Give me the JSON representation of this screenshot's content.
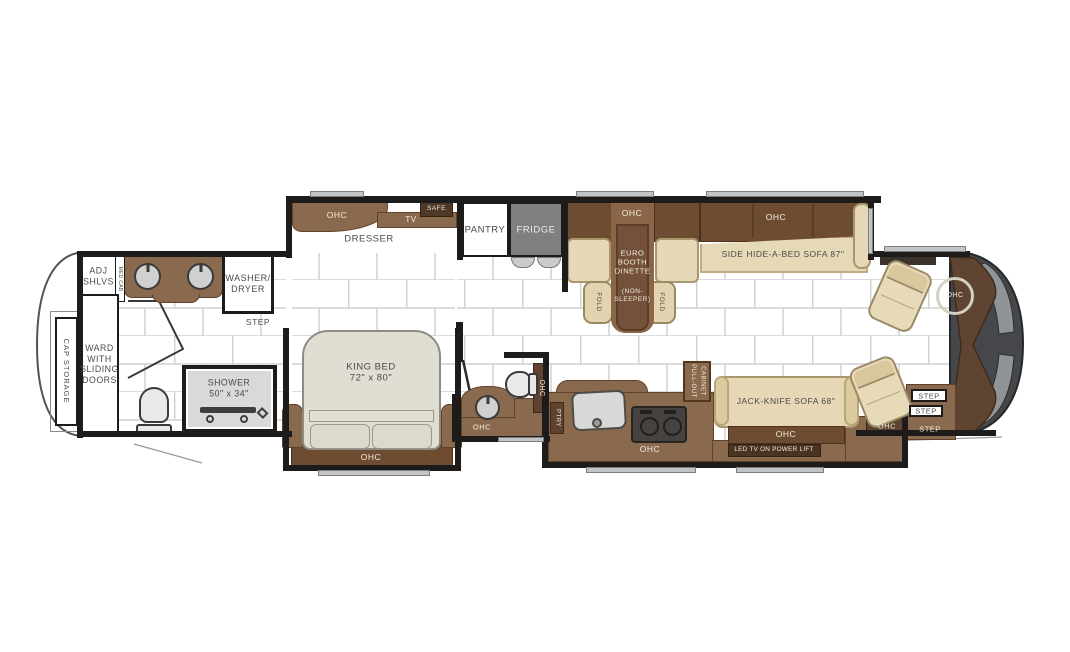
{
  "title": "Class A motorhome floor plan",
  "colors": {
    "wall": "#1d1c1a",
    "cabinet": "#8a6a4e",
    "cabinet_dark": "#6d4c32",
    "cabinet_deep": "#5f4330",
    "tan": "#e6d8b6",
    "bed": "#e0ddd3",
    "fridge_gray": "#7d7f81",
    "front_cap": "#45474a",
    "windshield": "#8f9497",
    "tile_line": "#cfcfcf",
    "label": "#4a4a4a",
    "label_light": "#f2ecdf"
  },
  "rooms": {
    "rear": {
      "cap_storage": "CAP STORAGE",
      "adj_shlvs": "ADJ\nSHLVS",
      "med_cab": "MED CAB",
      "washer_dryer": "WASHER/\nDRYER",
      "step": "STEP",
      "ward": "WARD\nWITH\nSLIDING\nDOORS",
      "shower": "SHOWER\n50\" x 34\""
    },
    "bedroom": {
      "ohc": "OHC",
      "tv": "TV",
      "safe": "SAFE",
      "dresser": "DRESSER",
      "king_bed": "KING BED\n72\" x 80\"",
      "ohc_foot": "OHC"
    },
    "mid_bath": {
      "ohc_wall": "OHC",
      "ohc_vanity": "OHC"
    },
    "galley": {
      "pantry": "PANTRY",
      "fridge": "FRIDGE",
      "ptry": "PTRY",
      "ohc": "OHC",
      "pull_out_cabinet": "PULL-OUT\nCABINET"
    },
    "dinette": {
      "ohc": "OHC",
      "booth_main": "EURO\nBOOTH\nDINETTE",
      "booth_sub": "(NON-\nSLEEPER)",
      "fold_left": "FOLD",
      "fold_right": "FOLD"
    },
    "living": {
      "ohc_sofa": "OHC",
      "hide_a_bed": "SIDE HIDE-A-BED SOFA 87\"",
      "jack_knife": "JACK-KNIFE SOFA 68\"",
      "ohc_jack": "OHC",
      "led_tv": "LED TV ON POWER LIFT"
    },
    "entry": {
      "ohc": "OHC",
      "step_1": "STEP",
      "step_2": "STEP",
      "step_3": "STEP"
    },
    "cockpit": {
      "ohc_dash": "OHC"
    }
  }
}
